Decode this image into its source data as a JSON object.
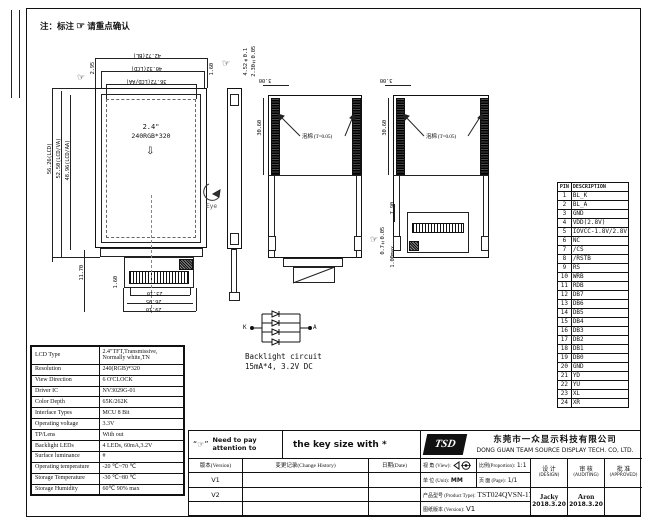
{
  "icons": {
    "pointing_hand": "☞",
    "down_arrow": "⇩"
  },
  "drawing": {
    "note": {
      "label": "注：标注",
      "confirm": "请重点确认"
    },
    "front_view": {
      "screen_size": "2.4\"",
      "screen_res": "240RGB*320",
      "dim_top": [
        "42.72(BL)",
        "40.32(LCD)",
        "36.72(LCD/AA)"
      ],
      "dim_left": [
        "56.26(LCD)",
        "52.50(LCD/VA)",
        "48.96(LCD/AA)"
      ],
      "dim_295": "2.95",
      "dim_160_top": "1.60",
      "dim_1170": "11.70",
      "dim_160_bottom": "1.60",
      "dim_bottom": [
        "23.10",
        "26.95",
        "29.10"
      ]
    },
    "side_view": {
      "dim_total": "4.52±0.1",
      "dim_panel": "2.30±0.05",
      "eye_label": "Eye"
    },
    "back_view_taped": {
      "dim_top": "3.00",
      "dim_side": "30.60",
      "foam_label": "泡棉 (T=0.05)"
    },
    "back_view_fpc": {
      "dim_top": "3.00",
      "dim_side": "30.60",
      "foam_label": "泡棉 (T=0.05)",
      "dim_790": "7.90",
      "dim_100max": "1.00max",
      "dim_07": "0.7±0.05"
    },
    "backlight": {
      "k": "K",
      "a": "A",
      "title": "Backlight circuit",
      "spec": "15mA*4, 3.2V DC"
    }
  },
  "pin_table": {
    "headers": [
      "PIN",
      "DESCRIPTION"
    ],
    "rows": [
      [
        "1",
        "BL_K"
      ],
      [
        "2",
        "BL_A"
      ],
      [
        "3",
        "GND"
      ],
      [
        "4",
        "VDD(2.8V)"
      ],
      [
        "5",
        "IOVCC-1.8V/2.8V"
      ],
      [
        "6",
        "NC"
      ],
      [
        "7",
        "/CS"
      ],
      [
        "8",
        "/RSTB"
      ],
      [
        "9",
        "RS"
      ],
      [
        "10",
        "WRB"
      ],
      [
        "11",
        "RDB"
      ],
      [
        "12",
        "DB7"
      ],
      [
        "13",
        "DB6"
      ],
      [
        "14",
        "DB5"
      ],
      [
        "15",
        "DB4"
      ],
      [
        "16",
        "DB3"
      ],
      [
        "17",
        "DB2"
      ],
      [
        "18",
        "DB1"
      ],
      [
        "19",
        "DB0"
      ],
      [
        "20",
        "GND"
      ],
      [
        "21",
        "YD"
      ],
      [
        "22",
        "YU"
      ],
      [
        "23",
        "XL"
      ],
      [
        "24",
        "XR"
      ]
    ]
  },
  "spec_table": {
    "rows": [
      [
        "LCD Type",
        "2.4\"TFT,Transmissive, Normally white,TN"
      ],
      [
        "Resolution",
        "240(RGB)*320"
      ],
      [
        "View Direction",
        "6 O'CLOCK"
      ],
      [
        "Driver IC",
        "NV3029G-01"
      ],
      [
        "Color Depth",
        "65K/262K"
      ],
      [
        "Interface Types",
        "MCU 8 Bit"
      ],
      [
        "Operating voltage",
        "3.3V"
      ],
      [
        "TP/Lens",
        "With out"
      ],
      [
        "Backlight LEDs",
        "4 LEDs,  60mA,3.2V"
      ],
      [
        "Surface luminance",
        "#"
      ],
      [
        "Operating temperature",
        "-20 ℃~70 ℃"
      ],
      [
        "Storage Temperature",
        "-30 ℃~80 ℃"
      ],
      [
        "Storage Humidity",
        "60℃ 90% max"
      ]
    ]
  },
  "title_block": {
    "attention": {
      "mark": "“☞”",
      "text": "Need to pay attention to"
    },
    "key_size_note": "the key size with *",
    "logo_text": "TSD",
    "company_cn": "东莞市一众显示科技有限公司",
    "company_en": "DONG GUAN TEAM SOURCE DISPLAY TECH. CO, LTD.",
    "history": {
      "headers": [
        "版本(Version)",
        "变更记录(Change History)",
        "日期(Date)"
      ],
      "rows": [
        "V1",
        "V2",
        ""
      ]
    },
    "info": {
      "view_label": "视 角 (View):",
      "proportion_label": "比例(Proportion):",
      "proportion_value": "1:1",
      "unit_label": "单 位 (Unit):",
      "unit_value": "MM",
      "page_label": "页 面 (Page):",
      "page_value": "1/1",
      "product_label": "产品型号 (Product Type):",
      "product_value": "TST024QVSN-17",
      "version_label": "图纸版本 (Version):",
      "version_value": "V1"
    },
    "signoff": [
      {
        "title": "设 计",
        "sub": "(DESIGN)",
        "name": "Jacky",
        "date": "2018.3.20"
      },
      {
        "title": "审 核",
        "sub": "(AUDITING)",
        "name": "Aron",
        "date": "2018.3.20"
      },
      {
        "title": "批 准",
        "sub": "(APPROVED)",
        "name": "",
        "date": ""
      }
    ]
  }
}
